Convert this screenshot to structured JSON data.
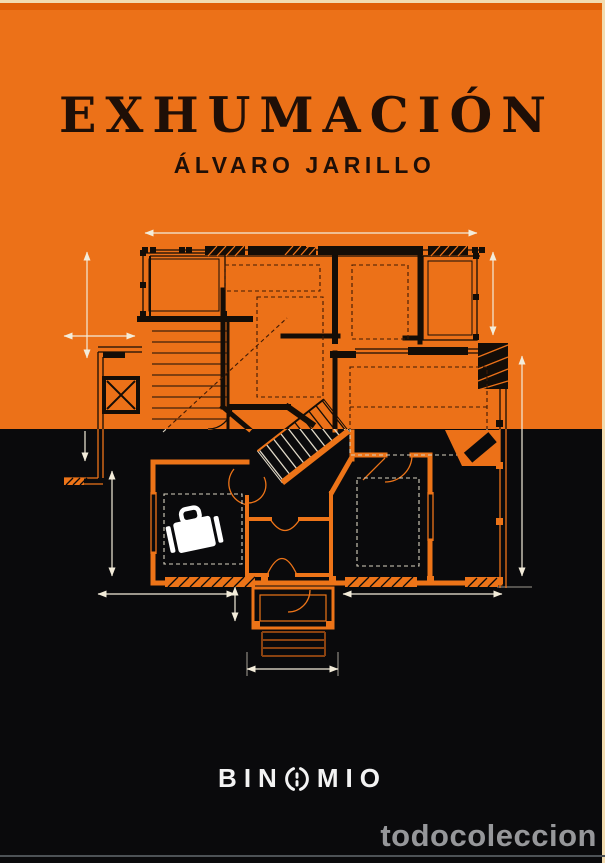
{
  "cover": {
    "title": "EXHUMACIÓN",
    "author": "ÁLVARO JARILLO",
    "publisher": {
      "name": "BINOMIO",
      "wordmark_left": "BIN",
      "wordmark_right": "MIO"
    },
    "colors": {
      "orange": "#ec7118",
      "black": "#0a0a0c",
      "ink": "#1f0f07",
      "dimension_line": "#f3ecda",
      "logo_white": "#f3f3f3",
      "watermark_gray": "#96979a"
    },
    "illustration": {
      "description": "Architectural floor plan split across an orange upper half (black linework) and a black lower half (orange linework), with dimension arrows, hatched walls, door swings, a diagonal staircase and a white suitcase.",
      "icons": [
        "suitcase-icon",
        "staircase",
        "dimension-arrows"
      ]
    }
  },
  "watermark": {
    "text": "todocoleccion"
  }
}
